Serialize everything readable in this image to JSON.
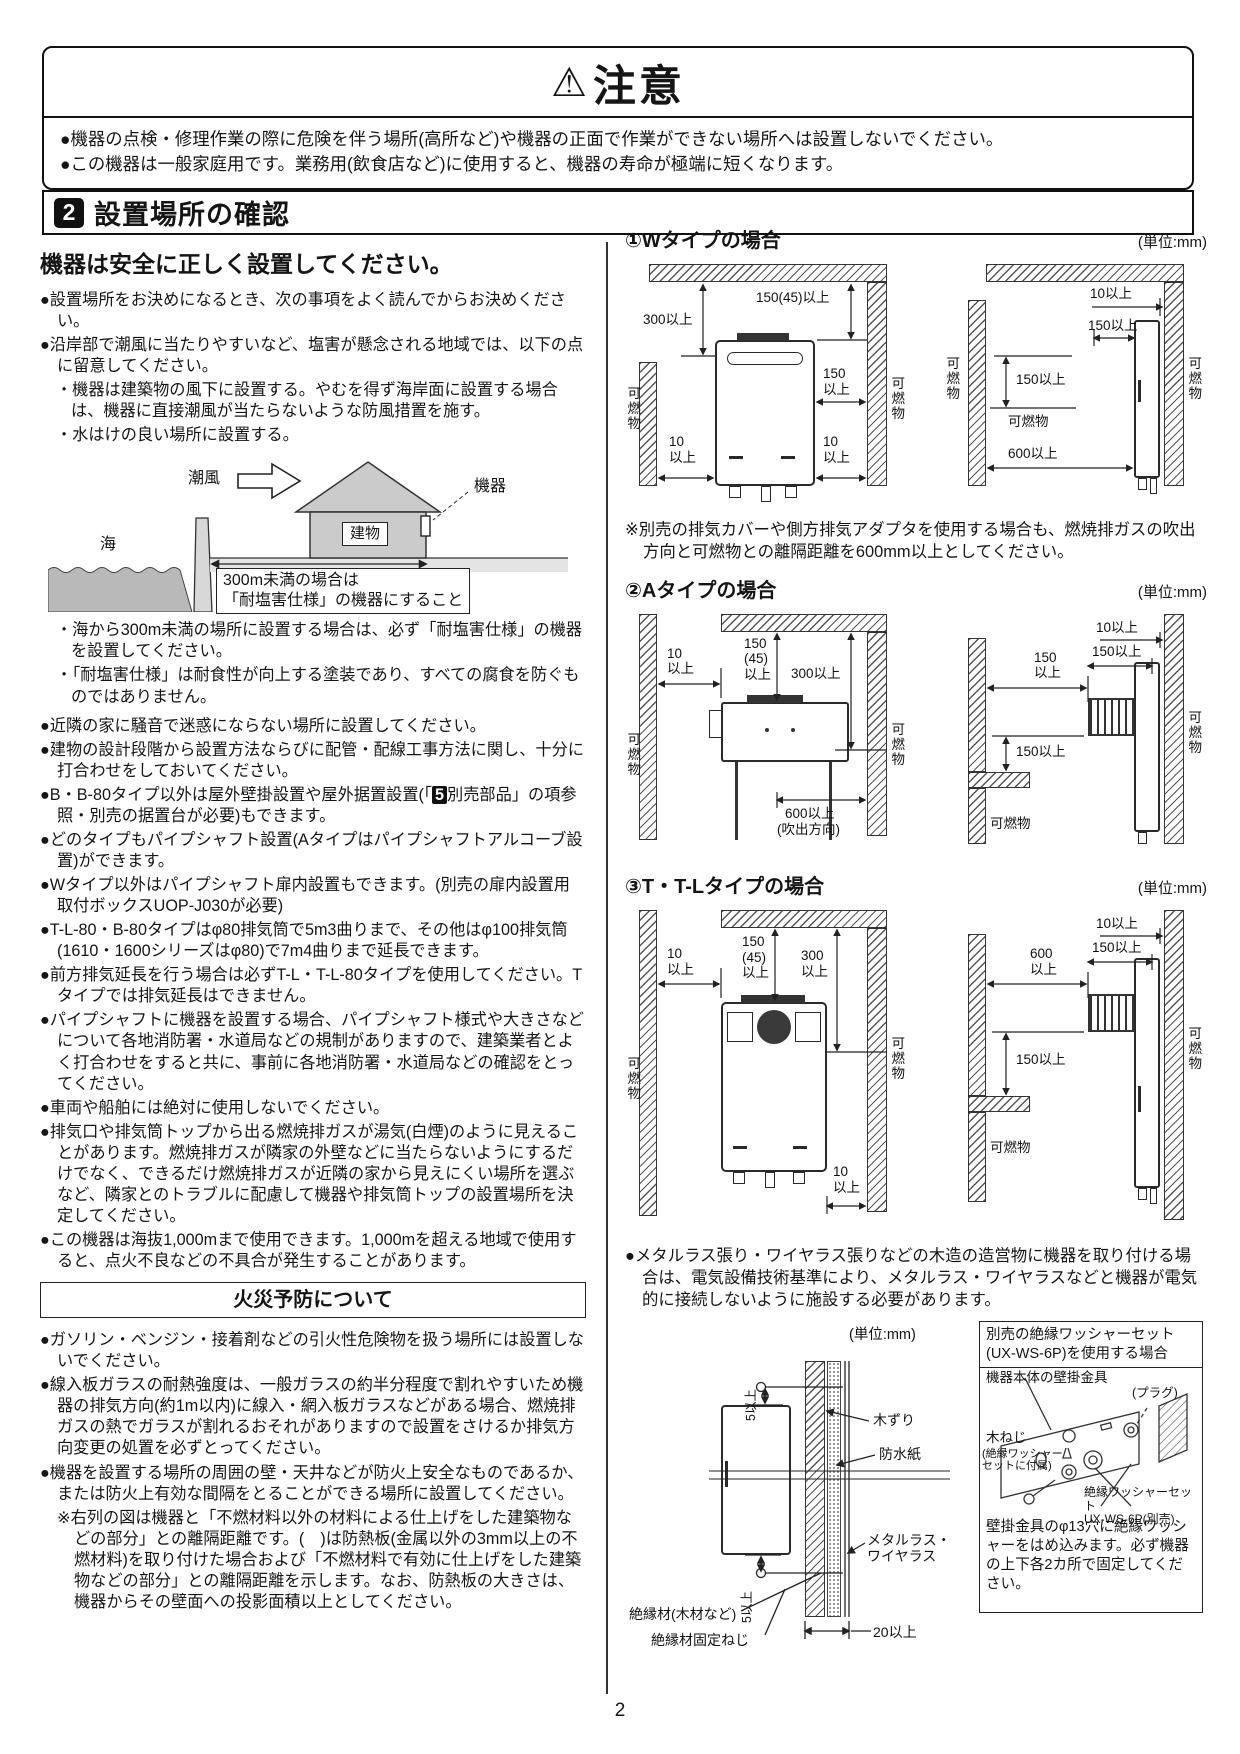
{
  "page": {
    "number": "2"
  },
  "caution": {
    "icon": "⚠",
    "title": "注意",
    "bullets": [
      "●機器の点検・修理作業の際に危険を伴う場所(高所など)や機器の正面で作業ができない場所へは設置しないでください。",
      "●この機器は一般家庭用です。業務用(飲食店など)に使用すると、機器の寿命が極端に短くなります。"
    ]
  },
  "section": {
    "number": "2",
    "title": "設置場所の確認"
  },
  "left": {
    "heading": "機器は安全に正しく設置してください。",
    "p1": "●設置場所をお決めになるとき、次の事項をよく読んでからお決めください。",
    "p2": "●沿岸部で潮風に当たりやすいなど、塩害が懸念される地域では、以下の点に留意してください。",
    "p3": "・機器は建築物の風下に設置する。やむを得ず海岸面に設置する場合は、機器に直接潮風が当たらないような防風措置を施す。",
    "p4": "・水はけの良い場所に設置する。",
    "sea": {
      "shiokaze": "潮風",
      "tatemono": "建物",
      "kiki": "機器",
      "umi": "海",
      "dim_label": "300m未満の場合は\n「耐塩害仕様」の機器にすること"
    },
    "p5": "・海から300m未満の場所に設置する場合は、必ず「耐塩害仕様」の機器を設置してください。",
    "p6": "・「耐塩害仕様」は耐食性が向上する塗装であり、すべての腐食を防ぐものではありません。",
    "p7": "●近隣の家に騒音で迷惑にならない場所に設置してください。",
    "p8": "●建物の設計段階から設置方法ならびに配管・配線工事方法に関し、十分に打合わせをしておいてください。",
    "p9_pre": "●B・B-80タイプ以外は屋外壁掛設置や屋外据置設置(「",
    "p9_num": "5",
    "p9_post": "別売部品」の項参照・別売の据置台が必要)もできます。",
    "p10": "●どのタイプもパイプシャフト設置(Aタイプはパイプシャフトアルコーブ設置)ができます。",
    "p11": "●Wタイプ以外はパイプシャフト扉内設置もできます。(別売の扉内設置用取付ボックスUOP-J030が必要)",
    "p12": "●T-L-80・B-80タイプはφ80排気筒で5m3曲りまで、その他はφ100排気筒(1610・1600シリーズはφ80)で7m4曲りまで延長できます。",
    "p13": "●前方排気延長を行う場合は必ずT-L・T-L-80タイプを使用してください。Tタイプでは排気延長はできません。",
    "p14": "●パイプシャフトに機器を設置する場合、パイプシャフト様式や大きさなどについて各地消防署・水道局などの規制がありますので、建築業者とよく打合わせをすると共に、事前に各地消防署・水道局などの確認をとってください。",
    "p15": "●車両や船舶には絶対に使用しないでください。",
    "p16": "●排気口や排気筒トップから出る燃焼排ガスが湯気(白煙)のように見えることがあります。燃焼排ガスが隣家の外壁などに当たらないようにするだけでなく、できるだけ燃焼排ガスが近隣の家から見えにくい場所を選ぶなど、隣家とのトラブルに配慮して機器や排気筒トップの設置場所を決定してください。",
    "p17": "●この機器は海抜1,000mまで使用できます。1,000mを超える地域で使用すると、点火不良などの不具合が発生することがあります。"
  },
  "fire": {
    "title": "火災予防について",
    "f1": "●ガソリン・ベンジン・接着剤などの引火性危険物を扱う場所には設置しないでください。",
    "f2": "●線入板ガラスの耐熱強度は、一般ガラスの約半分程度で割れやすいため機器の排気方向(約1m以内)に線入・網入板ガラスなどがある場合、燃焼排ガスの熱でガラスが割れるおそれがありますので設置をさけるか排気方向変更の処置を必ずとってください。",
    "f3": "●機器を設置する場所の周囲の壁・天井などが防火上安全なものであるか、または防火上有効な間隔をとることができる場所に設置してください。",
    "f3_note": "※右列の図は機器と「不燃材料以外の材料による仕上げをした建築物などの部分」との離隔距離です。(　)は防熱板(金属以外の3mm以上の不燃材料)を取り付けた場合および「不燃材料で有効に仕上げをした建築物などの部分」との離隔距離を示します。なお、防熱板の大きさは、機器からその壁面への投影面積以上としてください。"
  },
  "right": {
    "w": {
      "title": "①Wタイプの場合",
      "unit": "(単位:mm)",
      "front": {
        "d300": "300以上",
        "d150_45": "150(45)以上",
        "d150": "150\n以上",
        "d10l": "10\n以上",
        "d10r": "10\n以上",
        "kl": "可燃物",
        "kr": "可燃物"
      },
      "side": {
        "d10": "10以上",
        "d150a": "150以上",
        "d150b": "150以上",
        "k_bottom": "可燃物",
        "d600": "600以上",
        "kl": "可燃物",
        "kr": "可燃物"
      },
      "note": "※別売の排気カバーや側方排気アダプタを使用する場合も、燃焼排ガスの吹出方向と可燃物との離隔距離を600mm以上としてください。"
    },
    "a": {
      "title": "②Aタイプの場合",
      "unit": "(単位:mm)",
      "front": {
        "d10": "10\n以上",
        "d150_45": "150\n(45)\n以上",
        "d300": "300以上",
        "d600": "600以上",
        "d600sub": "(吹出方向)",
        "kl": "可燃物",
        "kr": "可燃物"
      },
      "side": {
        "d150a": "150\n以上",
        "d10": "10以上",
        "d150b": "150以上",
        "d150c": "150以上",
        "k_bottom": "可燃物",
        "kr": "可燃物"
      }
    },
    "t": {
      "title": "③T・T-Lタイプの場合",
      "unit": "(単位:mm)",
      "front": {
        "d10": "10\n以上",
        "d150_45": "150\n(45)\n以上",
        "d300": "300\n以上",
        "d10b": "10\n以上",
        "kl": "可燃物",
        "kr": "可燃物"
      },
      "side": {
        "d600": "600\n以上",
        "d10": "10以上",
        "d150a": "150以上",
        "d150b": "150以上",
        "k_bottom": "可燃物",
        "kr": "可燃物"
      }
    },
    "lath_bullet": "●メタルラス張り・ワイヤラス張りなどの木造の造営物に機器を取り付ける場合は、電気設備技術基準により、メタルラス・ワイヤラスなどと機器が電気的に接続しないように施設する必要があります。",
    "lath": {
      "unit": "(単位:mm)",
      "d5a": "5以上",
      "d5b": "5以上",
      "kizuri": "木ずり",
      "bousui": "防水紙",
      "metal": "メタルラス・\nワイヤラス",
      "zetsuen": "絶縁材(木材など)",
      "neji": "絶縁材固定ねじ",
      "d20": "20以上"
    },
    "washer": {
      "title": "別売の絶縁ワッシャーセット\n(UX-WS-6P)を使用する場合",
      "kanagu": "機器本体の壁掛金具",
      "plug": "(プラグ)",
      "kineji": "木ねじ",
      "kineji_sub": "(絶縁ワッシャー\nセットに付属)",
      "set": "絶縁ワッシャーセット\nUX-WS-6P(別売)",
      "body": "壁掛金具のφ13穴に絶縁ワッシャーをはめ込みます。必ず機器の上下各2カ所で固定してください。"
    }
  }
}
